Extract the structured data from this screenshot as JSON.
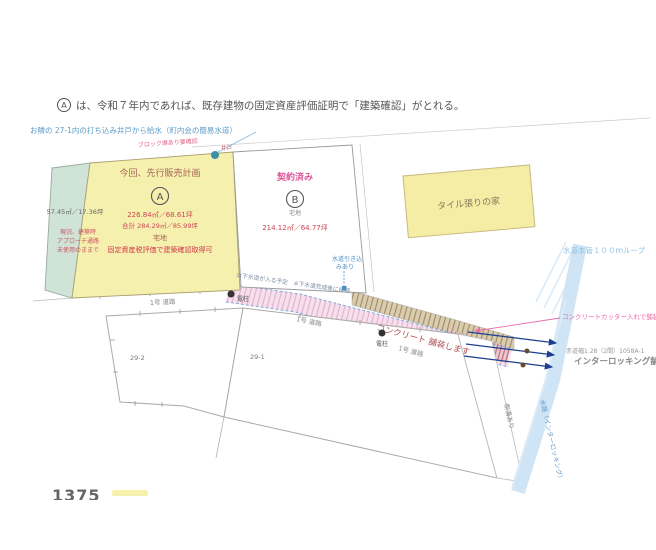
{
  "note_top": {
    "marker": "A",
    "text": "は、令和７年内であれば、既存建物の固定資産評価証明で「建築確認」がとれる。"
  },
  "well_note": {
    "text": "お隣の 27-1内の打ち込み井戸から給水（町内会の簡易水道）",
    "well_label": "井戸"
  },
  "plot_a": {
    "plan_label": "今回、先行販売計画",
    "marker": "A",
    "area": "226.84㎡／68.61坪",
    "area_total": "合計 284.29㎡／85.99坪",
    "land_type": "宅地",
    "approval_note": "固定資産税評価で建築確認取得可",
    "wall_note": "ブロック塀あり要確認",
    "strip_area": "57.45㎡／17.36坪",
    "strip_note_1": "現況、建築時",
    "strip_note_2": "アプローチ通路",
    "strip_note_3": "未使用のままで"
  },
  "plot_b": {
    "status": "契約済み",
    "marker": "B",
    "land_type": "宅地",
    "area": "214.12㎡／64.77坪"
  },
  "tile_house": {
    "label": "タイル張りの家"
  },
  "water_main": {
    "label": "水道本管１００ｍループ"
  },
  "road": {
    "paving_note": "コンクリート 舗装します",
    "sewer_note": "本下水道が入る予定　※下水道完成後に接続",
    "service_note_line1": "水道引き込",
    "service_note_line2": "みあり",
    "label_1": "1号 道路",
    "label_2": "1号 道路",
    "label_3": "1号 道路",
    "pole_label": "電柱"
  },
  "right_area": {
    "cutter_note": "コンクリートカッター入れで舗装します",
    "width_note": "赤道幅1.28（2間）1058A-1",
    "interlocking_note": "インターロッキング舗装",
    "gutter_note": "側溝あり",
    "waterway_note": "水路（インターロッキング）"
  },
  "parcels": {
    "left_label": "29-2",
    "right_label": "29-1"
  },
  "page_number": "1375"
}
